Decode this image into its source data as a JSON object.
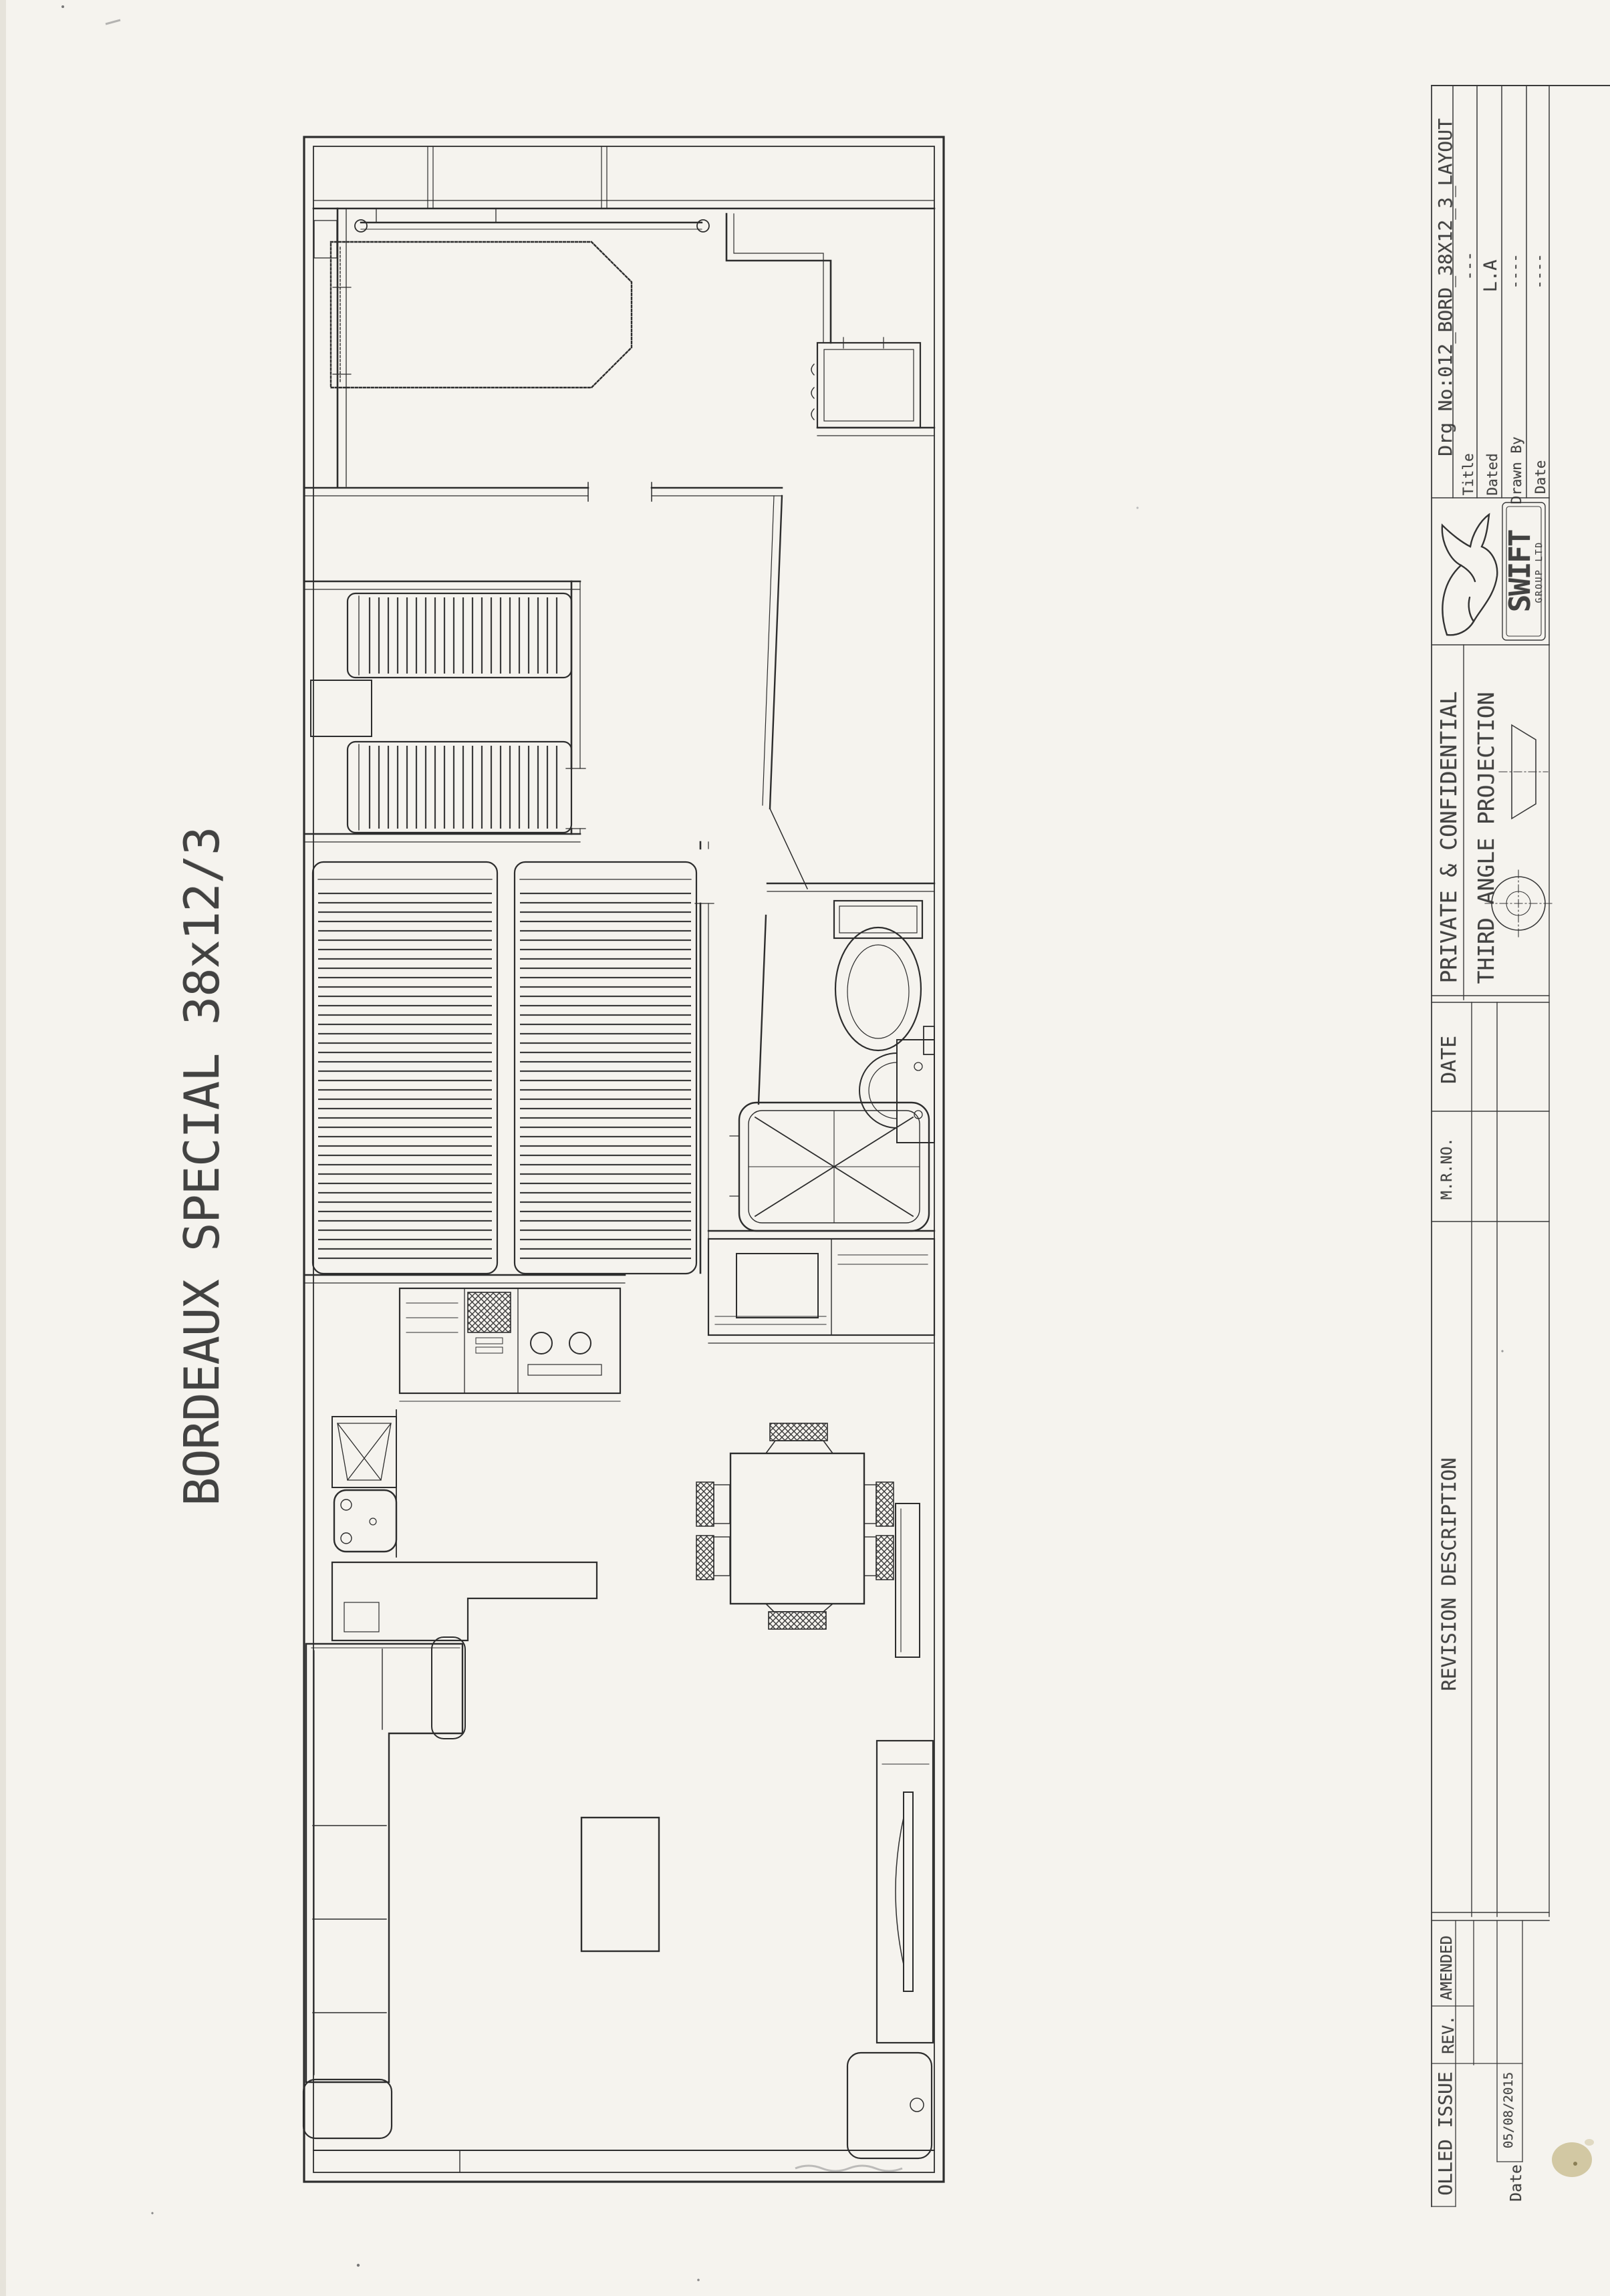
{
  "document": {
    "plan_title": "BORDEAUX SPECIAL 38x12/3"
  },
  "title_block": {
    "drg_row": "Drg No:012_BORD_38X12_3_LAYOUT",
    "fields": [
      {
        "label": "Title",
        "value": "---"
      },
      {
        "label": "Dated",
        "value": "L.A"
      },
      {
        "label": "Drawn By",
        "value": "----"
      },
      {
        "label": "Date",
        "value": "----"
      }
    ],
    "logo_name": "SWIFT",
    "logo_sub": "GROUP LTD",
    "confidential": "PRIVATE & CONFIDENTIAL",
    "projection": "THIRD ANGLE PROJECTION"
  },
  "revision_table": {
    "col_date": "DATE",
    "col_mr_no": "M.R.NO.",
    "col_description": "REVISION DESCRIPTION",
    "row_amended": "AMENDED",
    "row_rev": "REV.",
    "row_issue": "OLLED ISSUE",
    "issue_date": "05/08/2015",
    "date_label": "Date"
  }
}
